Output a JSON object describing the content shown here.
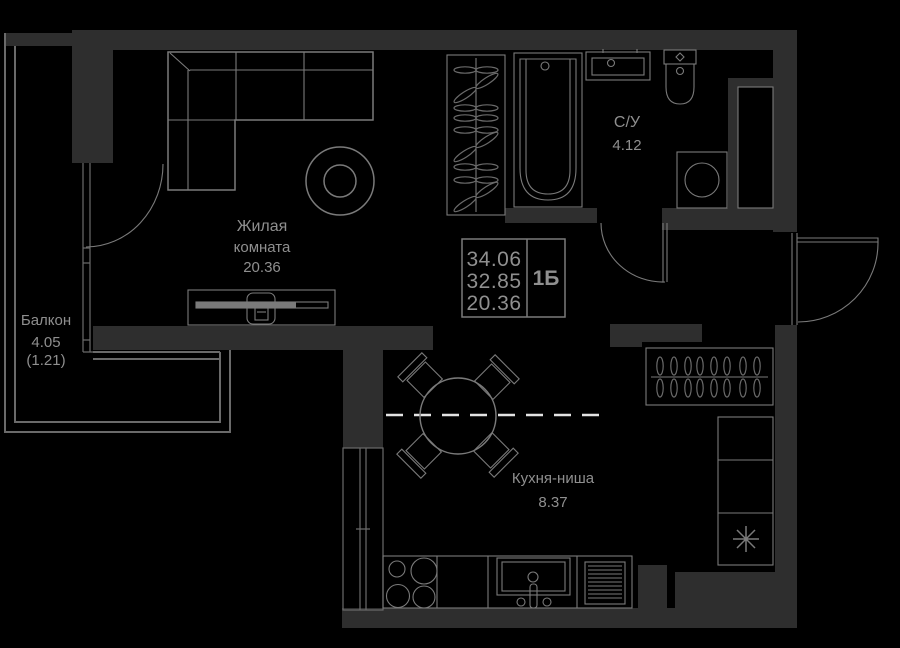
{
  "rooms": {
    "living": {
      "name1": "Жилая",
      "name2": "комната",
      "area": "20.36"
    },
    "balcony": {
      "name": "Балкон",
      "area": "4.05",
      "area_coef": "(1.21)"
    },
    "bathroom": {
      "name": "С/У",
      "area": "4.12"
    },
    "kitchen": {
      "name": "Кухня-ниша",
      "area": "8.37"
    }
  },
  "info_box": {
    "values": [
      "34.06",
      "32.85",
      "20.36"
    ],
    "type_label": "1Б"
  },
  "colors": {
    "bg": "#000000",
    "wall": "#2e2e2e",
    "line": "#7a7a7a",
    "line_soft": "#6a6a6a",
    "text": "#8f8f8f",
    "dash": "#e3e3e3"
  }
}
